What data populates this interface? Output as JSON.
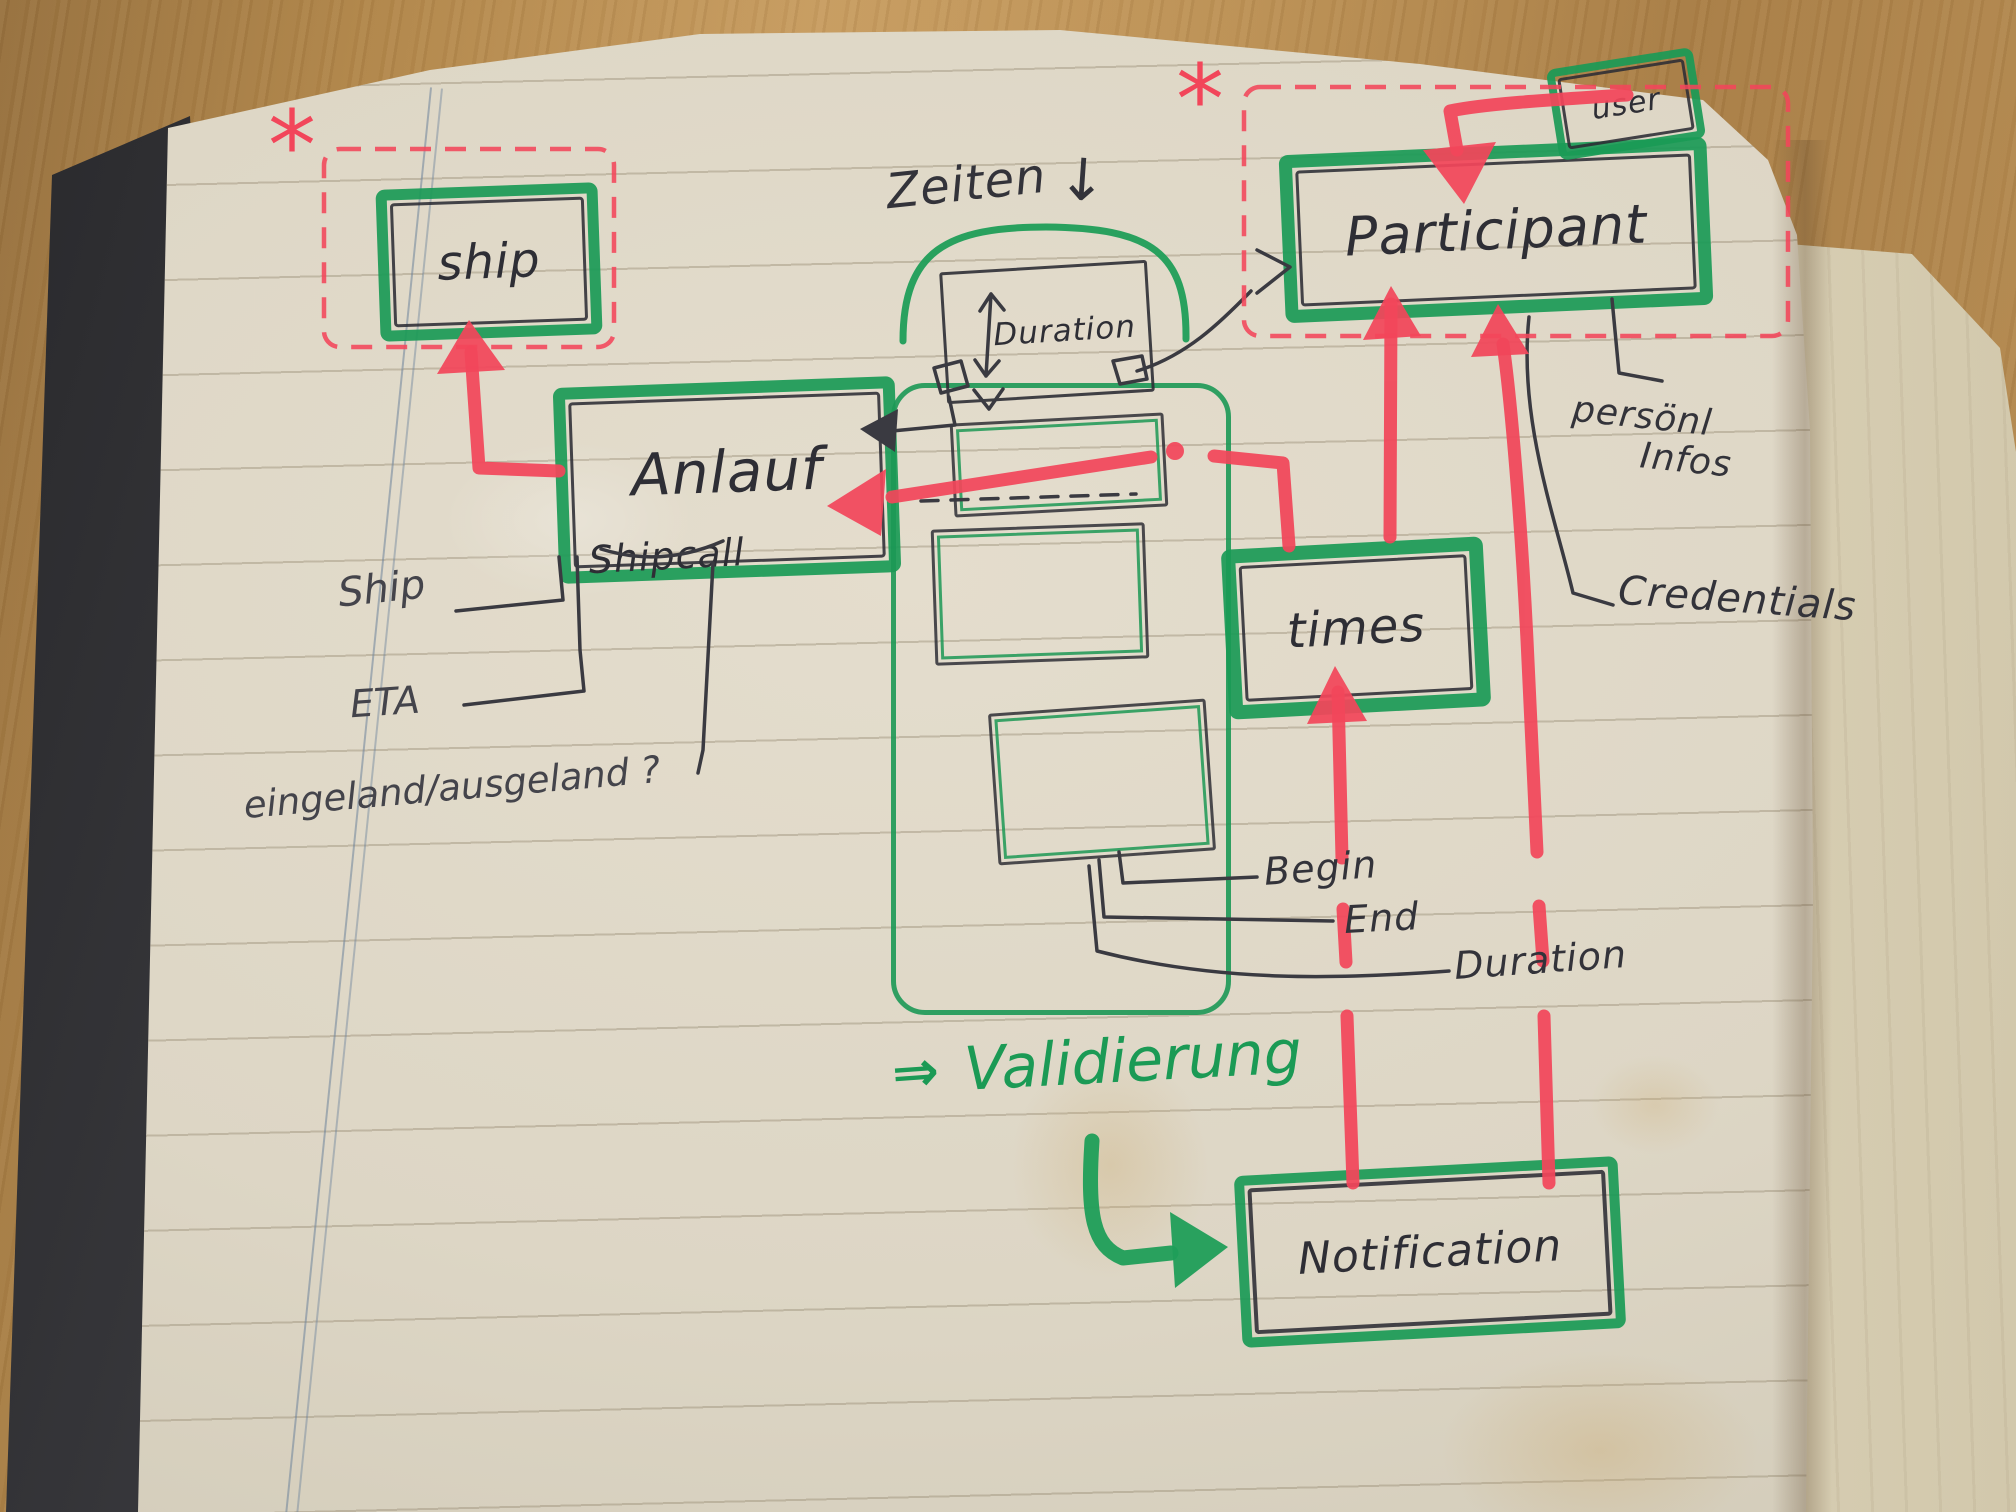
{
  "scene": {
    "type": "hand-drawn data model sketch on notebook page",
    "asterisk": "*",
    "colors": {
      "marker_green": "#1f9e58",
      "marker_red": "#f2465a",
      "ink": "#2e2e35",
      "paper": "#ddd6c5",
      "wood": "#b2874f"
    }
  },
  "entities": {
    "ship": {
      "label": "ship"
    },
    "anlauf": {
      "label": "Anlauf",
      "sublabel": "Shipcall"
    },
    "duration_box": {
      "label": "Duration"
    },
    "participant": {
      "label": "Participant"
    },
    "user": {
      "label": "user"
    },
    "times": {
      "label": "times"
    },
    "notification": {
      "label": "Notification"
    }
  },
  "attributes": {
    "ship_ref": "Ship",
    "eta": "ETA",
    "in_out": "eingeland/ausgeland ?",
    "begin": "Begin",
    "end": "End",
    "duration": "Duration",
    "personal_line1": "persönl",
    "personal_line2": "Infos",
    "credentials": "Credentials"
  },
  "notes": {
    "zeiten_label": "Zeiten",
    "zeiten_arrow": "↓",
    "validation_label": "Validierung",
    "validation_arrow": "⇒"
  }
}
